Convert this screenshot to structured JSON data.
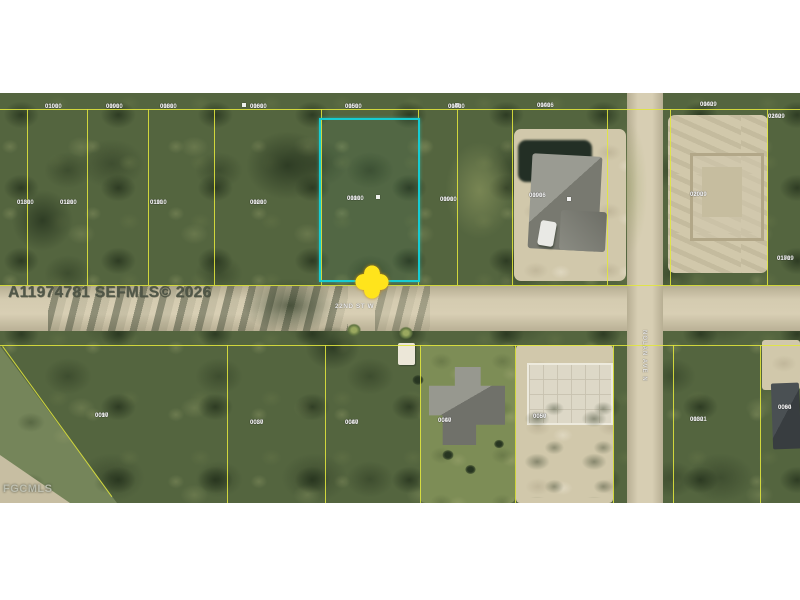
{
  "photo": {
    "mls_watermark": "A11974781 SEFMLS© 2026",
    "agency_watermark": "FGCMLS"
  },
  "streets": {
    "horizontal_label": "22ND ST W",
    "vertical_label": "NOLAN AVE N"
  },
  "colors": {
    "highlight_border": "#17ccd2",
    "marker": "#ffe41c",
    "parcel_line": "#e1e63c"
  },
  "parcel_labels": [
    {
      "x": 45,
      "y": 11,
      "line1": "01010",
      "line2": "0100"
    },
    {
      "x": 106,
      "y": 11,
      "line1": "01010",
      "line2": "0090"
    },
    {
      "x": 160,
      "y": 11,
      "line1": "01010",
      "line2": "0080"
    },
    {
      "x": 250,
      "y": 11,
      "line1": "01010",
      "line2": "0060"
    },
    {
      "x": 345,
      "y": 11,
      "line1": "01010",
      "line2": "0050"
    },
    {
      "x": 448,
      "y": 11,
      "line1": "01010",
      "line2": "0040"
    },
    {
      "x": 537,
      "y": 10,
      "line1": "01016",
      "line2": "0040"
    },
    {
      "x": 700,
      "y": 9,
      "line1": "01029",
      "line2": "0040"
    },
    {
      "x": 768,
      "y": 21,
      "line1": "01029",
      "line2": "0240"
    },
    {
      "x": 17,
      "y": 107,
      "line1": "01010",
      "line2": "0130"
    },
    {
      "x": 60,
      "y": 107,
      "line1": "01010",
      "line2": "0120"
    },
    {
      "x": 150,
      "y": 107,
      "line1": "01010",
      "line2": "0110"
    },
    {
      "x": 250,
      "y": 107,
      "line1": "01010",
      "line2": "0020"
    },
    {
      "x": 347,
      "y": 103,
      "line1": "01010",
      "line2": "0010"
    },
    {
      "x": 440,
      "y": 104,
      "line1": "01010",
      "line2": "0090"
    },
    {
      "x": 529,
      "y": 100,
      "line1": "01016",
      "line2": "0090"
    },
    {
      "x": 690,
      "y": 99,
      "line1": "01029",
      "line2": "0200"
    },
    {
      "x": 777,
      "y": 163,
      "line1": "01019",
      "line2": "0170"
    },
    {
      "x": 95,
      "y": 320,
      "line1": "0097",
      "line2": "0010"
    },
    {
      "x": 250,
      "y": 327,
      "line1": "0087",
      "line2": "0030"
    },
    {
      "x": 345,
      "y": 327,
      "line1": "0087",
      "line2": "0040"
    },
    {
      "x": 438,
      "y": 325,
      "line1": "0087",
      "line2": "0040"
    },
    {
      "x": 533,
      "y": 321,
      "line1": "0087",
      "line2": "0050"
    },
    {
      "x": 690,
      "y": 324,
      "line1": "01021",
      "line2": "0030"
    },
    {
      "x": 778,
      "y": 312,
      "line1": "0094",
      "line2": "0060"
    }
  ]
}
